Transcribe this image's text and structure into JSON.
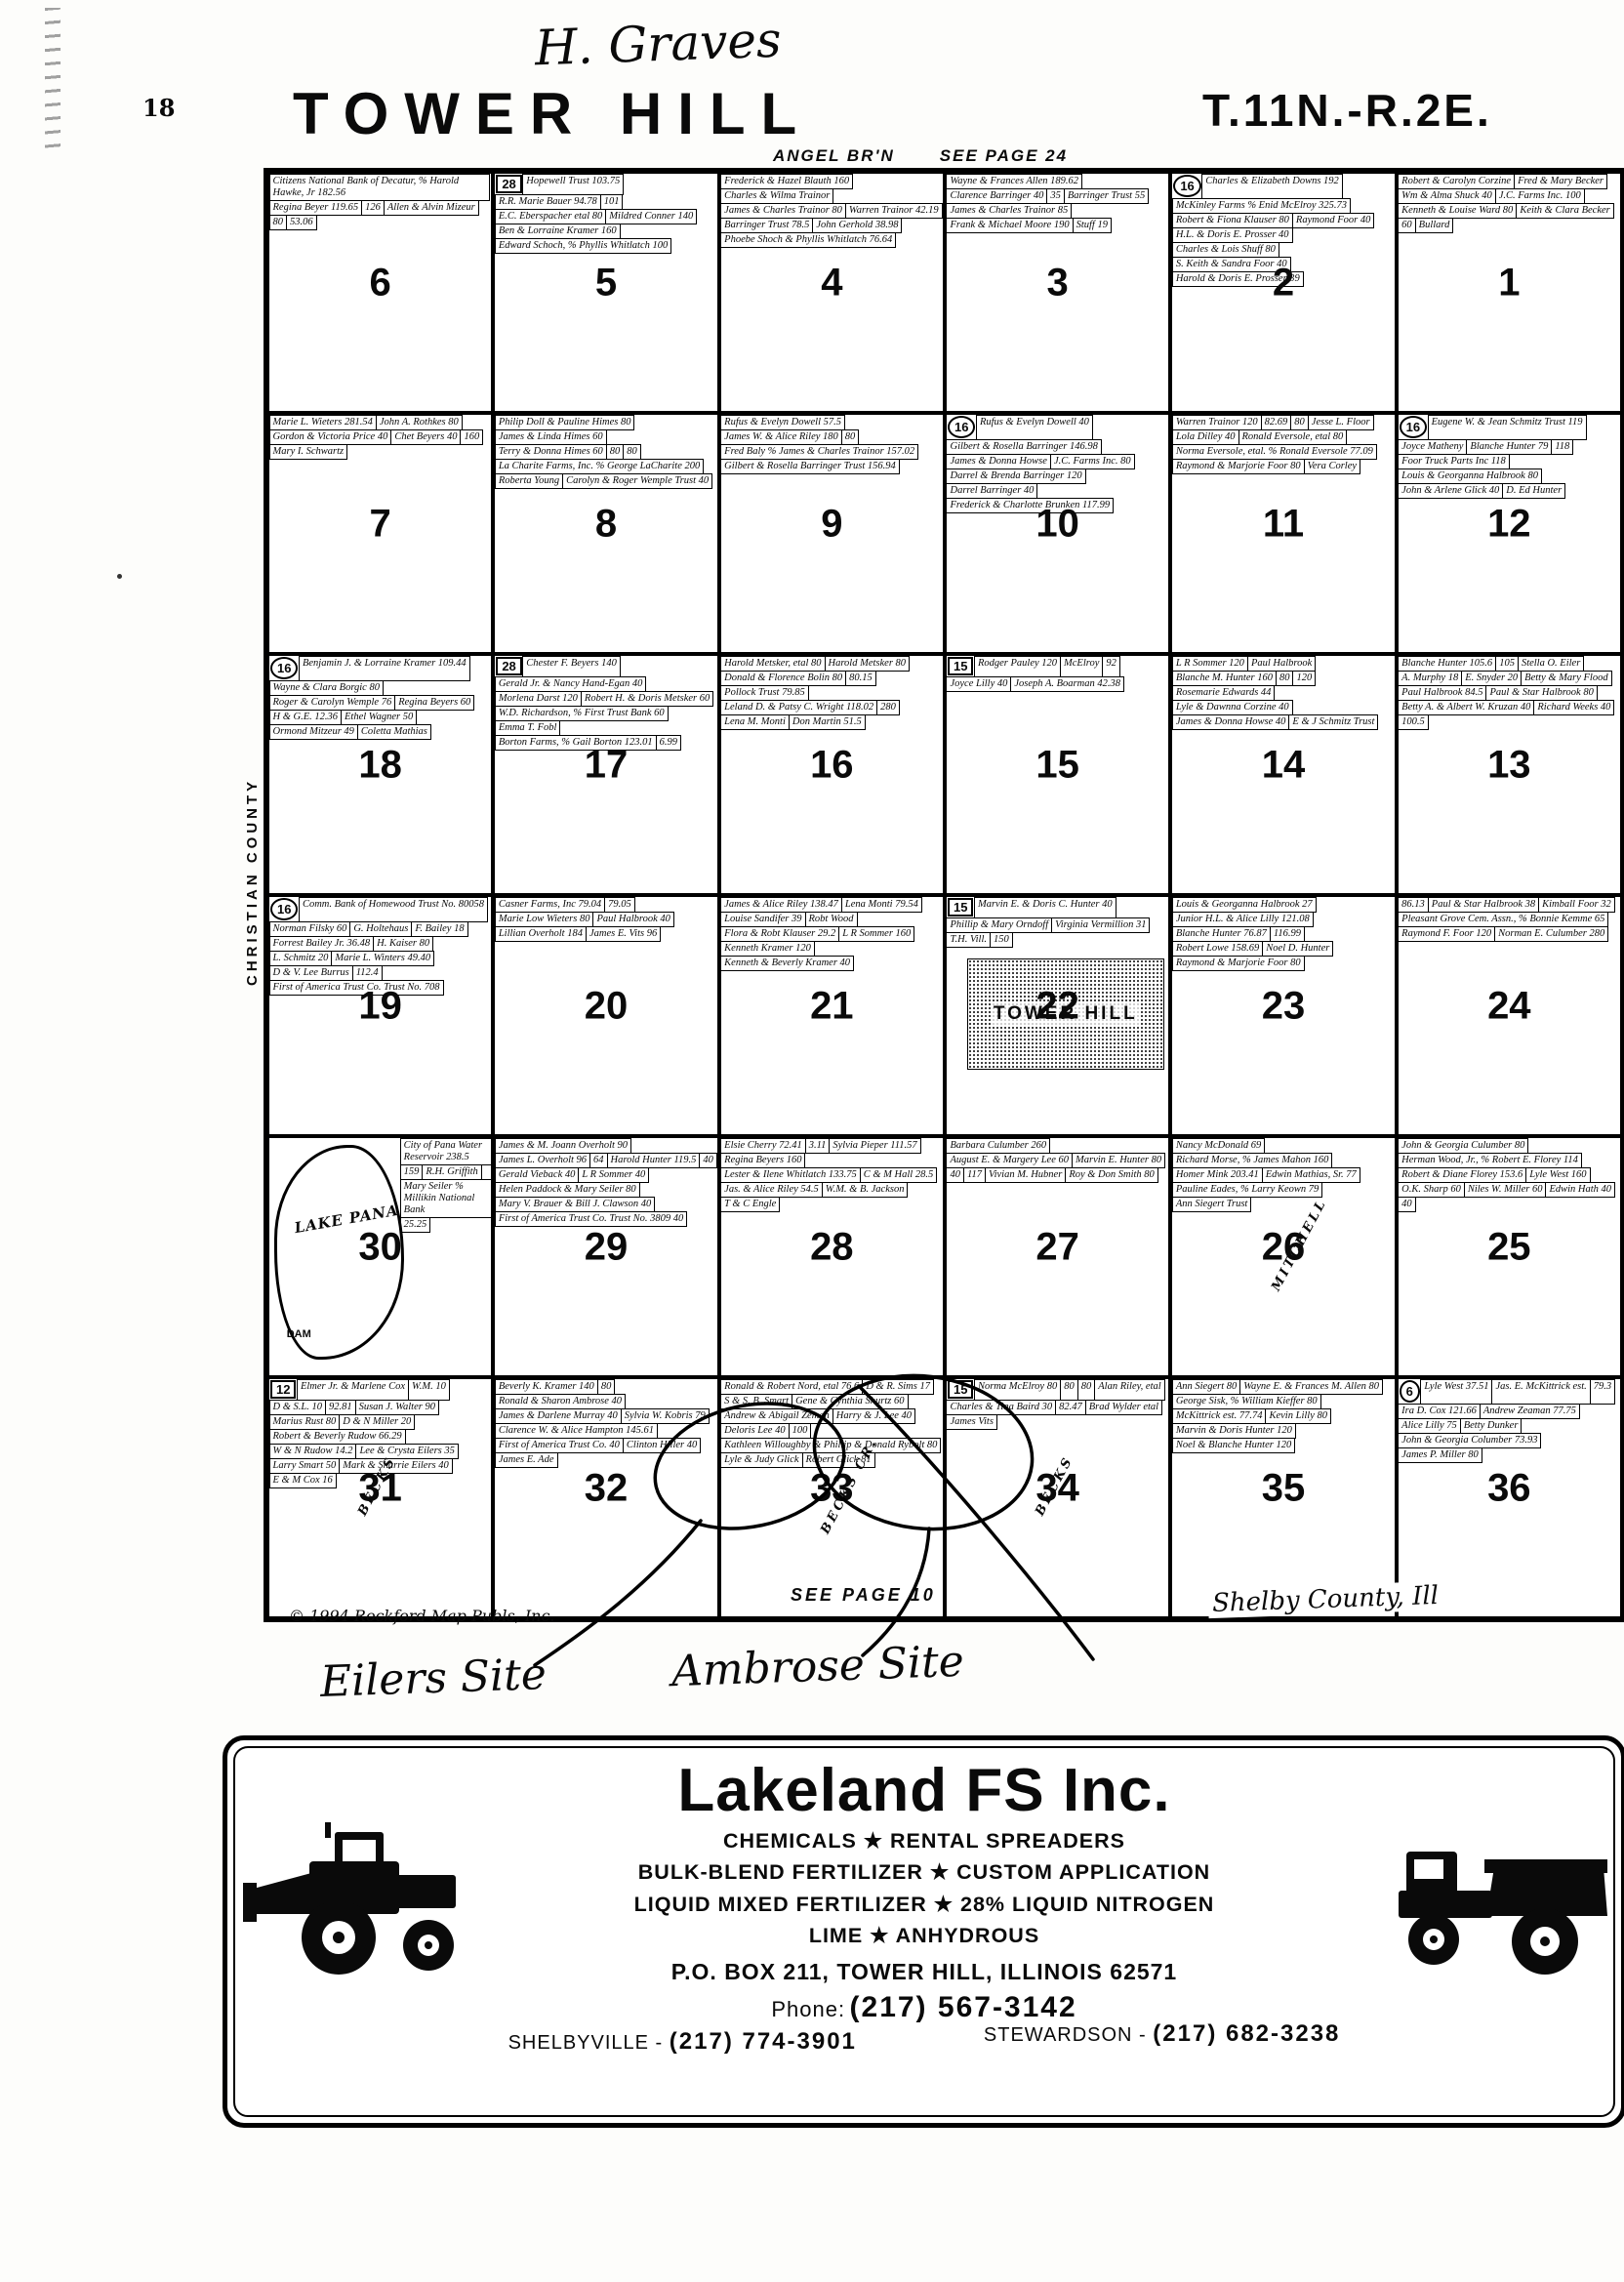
{
  "header": {
    "page_number": "18",
    "handwritten_name": "H. Graves",
    "title": "TOWER HILL",
    "township_range": "T.11N.-R.2E.",
    "stream_note": "ANGEL BR'N",
    "see_page_top": "SEE PAGE 24"
  },
  "footer": {
    "see_page_bottom": "SEE PAGE 10",
    "copyright": "© 1994 Rockford Map Publs, Inc.",
    "county_left": "CHRISTIAN COUNTY",
    "county_bottom": "Shelby County, Ill",
    "annotation_eilers": "Eilers Site",
    "annotation_ambrose": "Ambrose Site"
  },
  "map": {
    "sections": [
      {
        "n": "6",
        "parcels": [
          "Citizens National Bank of Decatur, % Harold Hawke, Jr 182.56",
          "Regina Beyer 119.65",
          "126",
          "Allen & Alvin Mizeur",
          "80",
          "53.06"
        ]
      },
      {
        "n": "5",
        "badges": [
          "28"
        ],
        "parcels": [
          "Hopewell Trust 103.75",
          "R.R. Marie Bauer 94.78",
          "101",
          "E.C. Eberspacher etal 80",
          "Mildred Conner 140",
          "Ben & Lorraine Kramer 160",
          "Edward Schoch, % Phyllis Whitlatch 100"
        ]
      },
      {
        "n": "4",
        "parcels": [
          "Frederick & Hazel Blauth 160",
          "Charles & Wilma Trainor",
          "James & Charles Trainor 80",
          "Warren Trainor 42.19",
          "Barringer Trust 78.5",
          "John Gerhold 38.98",
          "Phoebe Shoch & Phyllis Whitlatch 76.64"
        ]
      },
      {
        "n": "3",
        "parcels": [
          "Wayne & Frances Allen 189.62",
          "Clarence Barringer 40",
          "35",
          "Barringer Trust 55",
          "James & Charles Trainor 85",
          "Frank & Michael Moore 190",
          "Stuff 19"
        ]
      },
      {
        "n": "2",
        "badges": [
          "16"
        ],
        "parcels": [
          "Charles & Elizabeth Downs 192",
          "McKinley Farms % Enid McElroy 325.73",
          "Robert & Fiona Klauser 80",
          "Raymond Foor 40",
          "H.L. & Doris E. Prosser 40",
          "Charles & Lois Shuff 80",
          "S. Keith & Sandra Foor 40",
          "Harold & Doris E. Prosser 39"
        ]
      },
      {
        "n": "1",
        "parcels": [
          "Robert & Carolyn Corzine",
          "Fred & Mary Becker",
          "Wm & Alma Shuck 40",
          "J.C. Farms Inc. 100",
          "Kenneth & Louise Ward 80",
          "Keith & Clara Becker",
          "60",
          "Bullard"
        ]
      },
      {
        "n": "7",
        "parcels": [
          "Marie L. Wieters 281.54",
          "John A. Rothkes 80",
          "Gordon & Victoria Price 40",
          "Chet Beyers 40",
          "160",
          "Mary I. Schwartz"
        ]
      },
      {
        "n": "8",
        "parcels": [
          "Philip Doll & Pauline Himes 80",
          "James & Linda Himes 60",
          "Terry & Donna Himes 60",
          "80",
          "80",
          "La Charite Farms, Inc. % George LaCharite 200",
          "Roberta Young",
          "Carolyn & Roger Wemple Trust 40"
        ]
      },
      {
        "n": "9",
        "parcels": [
          "Rufus & Evelyn Dowell 57.5",
          "James W. & Alice Riley 180",
          "80",
          "Fred Baly % James & Charles Trainor 157.02",
          "Gilbert & Rosella Barringer Trust 156.94"
        ]
      },
      {
        "n": "10",
        "badges": [
          "16"
        ],
        "parcels": [
          "Rufus & Evelyn Dowell 40",
          "Gilbert & Rosella Barringer 146.98",
          "James & Donna Howse",
          "J.C. Farms Inc. 80",
          "Darrel & Brenda Barringer 120",
          "Darrel Barringer 40",
          "Frederick & Charlotte Brunken 117.99"
        ]
      },
      {
        "n": "11",
        "parcels": [
          "Warren Trainor 120",
          "82.69",
          "80",
          "Jesse L. Floor",
          "Lola Dilley 40",
          "Ronald Eversole, etal 80",
          "Norma Eversole, etal. % Ronald Eversole 77.09",
          "Raymond & Marjorie Foor 80",
          "Vera Corley"
        ]
      },
      {
        "n": "12",
        "badges": [
          "16"
        ],
        "parcels": [
          "Eugene W. & Jean Schmitz Trust 119",
          "Joyce Matheny",
          "Blanche Hunter 79",
          "118",
          "Foor Truck Parts Inc 118",
          "Louis & Georganna Halbrook 80",
          "John & Arlene Glick 40",
          "D. Ed Hunter"
        ]
      },
      {
        "n": "18",
        "badges": [
          "16"
        ],
        "parcels": [
          "Benjamin J. & Lorraine Kramer 109.44",
          "Wayne & Clara Borgic 80",
          "Roger & Carolyn Wemple 76",
          "Regina Beyers 60",
          "H & G.E. 12.36",
          "Ethel Wagner 50",
          "Ormond Mitzeur 49",
          "Coletta Mathias"
        ]
      },
      {
        "n": "17",
        "badges": [
          "28"
        ],
        "parcels": [
          "Chester F. Beyers 140",
          "Gerald Jr. & Nancy Hand-Egan 40",
          "Morlena Darst 120",
          "Robert H. & Doris Metsker 60",
          "W.D. Richardson, % First Trust Bank 60",
          "Emma T. Fobl",
          "Borton Farms, % Gail Borton 123.01",
          "6.99"
        ]
      },
      {
        "n": "16",
        "parcels": [
          "Harold Metsker, etal 80",
          "Harold Metsker 80",
          "Donald & Florence Bolin 80",
          "80.15",
          "Pollock Trust 79.85",
          "Leland D. & Patsy C. Wright 118.02",
          "280",
          "Lena M. Monti",
          "Don Martin 51.5"
        ]
      },
      {
        "n": "15",
        "badges": [
          "15"
        ],
        "parcels": [
          "Rodger Pauley 120",
          "McElroy",
          "92",
          "Joyce Lilly 40",
          "Joseph A. Boarman 42.38"
        ]
      },
      {
        "n": "14",
        "parcels": [
          "L R Sommer 120",
          "Paul Halbrook",
          "Blanche M. Hunter 160",
          "80",
          "120",
          "Rosemarie Edwards 44",
          "Lyle & Dawnna Corzine 40",
          "James & Donna Howse 40",
          "E & J Schmitz Trust"
        ]
      },
      {
        "n": "13",
        "parcels": [
          "Blanche Hunter 105.6",
          "105",
          "Stella O. Eiler",
          "A. Murphy 18",
          "E. Snyder 20",
          "Betty & Mary Flood",
          "Paul Halbrook 84.5",
          "Paul & Star Halbrook 80",
          "Betty A. & Albert W. Kruzan 40",
          "Richard Weeks 40",
          "100.5"
        ]
      },
      {
        "n": "19",
        "badges": [
          "16"
        ],
        "parcels": [
          "Comm. Bank of Homewood Trust No. 80058",
          "Norman Filsky 60",
          "G. Holtehaus",
          "F. Bailey 18",
          "Forrest Bailey Jr. 36.48",
          "H. Kaiser 80",
          "L. Schmitz 20",
          "Marie L. Winters 49.40",
          "D & V. Lee Burrus",
          "112.4",
          "First of America Trust Co. Trust No. 708"
        ]
      },
      {
        "n": "20",
        "parcels": [
          "Casner Farms, Inc 79.04",
          "79.05",
          "Marie Low Wieters 80",
          "Paul Halbrook 40",
          "Lillian Overholt 184",
          "James E. Vits 96"
        ]
      },
      {
        "n": "21",
        "parcels": [
          "James & Alice Riley 138.47",
          "Lena Monti 79.54",
          "Louise Sandifer 39",
          "Robt Wood",
          "Flora & Robt Klauser 29.2",
          "L R Sommer 160",
          "Kenneth Kramer 120",
          "Kenneth & Beverly Kramer 40"
        ]
      },
      {
        "n": "22",
        "badges": [
          "15"
        ],
        "town": "TOWER HILL",
        "parcels": [
          "Marvin E. & Doris C. Hunter 40",
          "Phillip & Mary Orndoff",
          "Virginia Vermillion 31",
          "T.H. Vill.",
          "150"
        ]
      },
      {
        "n": "23",
        "parcels": [
          "Louis & Georganna Halbrook 27",
          "Junior H.L. & Alice Lilly 121.08",
          "Blanche Hunter 76.87",
          "116.99",
          "Robert Lowe 158.69",
          "Noel D. Hunter",
          "Raymond & Marjorie Foor 80"
        ]
      },
      {
        "n": "24",
        "parcels": [
          "86.13",
          "Paul & Star Halbrook 38",
          "Kimball Foor 32",
          "Pleasant Grove Cem. Assn., % Bonnie Kemme 65",
          "Raymond F. Foor 120",
          "Norman E. Culumber 280"
        ]
      },
      {
        "n": "30",
        "lake": {
          "name": "LAKE PANA",
          "dam": "DAM"
        },
        "parcels": [
          "City of Pana Water Reservoir 238.5",
          "159",
          "R.H. Griffith",
          "Mary Seiler % Millikin National Bank",
          "25.25"
        ]
      },
      {
        "n": "29",
        "parcels": [
          "James & M. Joann Overholt 90",
          "James L. Overholt 96",
          "64",
          "Harold Hunter 119.5",
          "40",
          "Gerald Vieback 40",
          "L R Sommer 40",
          "Helen Paddock & Mary Seiler 80",
          "Mary V. Brauer & Bill J. Clawson 40",
          "First of America Trust Co. Trust No. 3809 40"
        ]
      },
      {
        "n": "28",
        "parcels": [
          "Elsie Cherry 72.41",
          "3.11",
          "Sylvia Pieper 111.57",
          "Regina Beyers 160",
          "Lester & Ilene Whitlatch 133.75",
          "C & M Hall 28.5",
          "Jas. & Alice Riley 54.5",
          "W.M. & B. Jackson",
          "T & C Engle"
        ]
      },
      {
        "n": "27",
        "parcels": [
          "Barbara Culumber 260",
          "August E. & Margery Lee 60",
          "Marvin E. Hunter 80",
          "40",
          "117",
          "Vivian M. Hubner",
          "Roy & Don Smith 80"
        ]
      },
      {
        "n": "26",
        "creek": "MITCHELL",
        "parcels": [
          "Nancy McDonald 69",
          "Richard Morse, % James Mahon 160",
          "Homer Mink 203.41",
          "Edwin Mathias, Sr. 77",
          "Pauline Eades, % Larry Keown 79",
          "Ann Siegert Trust"
        ]
      },
      {
        "n": "25",
        "parcels": [
          "John & Georgia Culumber 80",
          "Herman Wood, Jr., % Robert E. Florey 114",
          "Robert & Diane Florey 153.6",
          "Lyle West 160",
          "O.K. Sharp 60",
          "Niles W. Miller 60",
          "Edwin Hath 40",
          "40"
        ]
      },
      {
        "n": "31",
        "badges": [
          "12"
        ],
        "creek": "BECKS",
        "parcels": [
          "Elmer Jr. & Marlene Cox",
          "W.M. 10",
          "D & S.L. 10",
          "92.81",
          "Susan J. Walter 90",
          "Marius Rust 80",
          "D & N Miller 20",
          "Robert & Beverly Rudow 66.29",
          "W & N Rudow 14.2",
          "Lee & Crysta Eilers 35",
          "Larry Smart 50",
          "Mark & Sharrie Eilers 40",
          "E & M Cox 16"
        ]
      },
      {
        "n": "32",
        "parcels": [
          "Beverly K. Kramer 140",
          "80",
          "Ronald & Sharon Ambrose 40",
          "James & Darlene Murray 40",
          "Sylvia W. Kobris 79",
          "Clarence W. & Alice Hampton 145.61",
          "First of America Trust Co. 40",
          "Clinton Hiller 40",
          "James E. Ade"
        ]
      },
      {
        "n": "33",
        "creek": "BECKS CR.",
        "parcels": [
          "Ronald & Robert Nord, etal 76.6",
          "D & R. Sims 17",
          "S & S. B. Smart",
          "Gene & Cynthia Shurtz 60",
          "Andrew & Abigail Zeman",
          "Harry & J. Lee 40",
          "Deloris Lee 40",
          "100",
          "Kathleen Willoughby & Phillip & Donald Rybolt 80",
          "Lyle & Judy Glick",
          "Robert Glick 81"
        ]
      },
      {
        "n": "34",
        "badges": [
          "15"
        ],
        "creek": "BECKS",
        "parcels": [
          "Norma McElroy 80",
          "80",
          "80",
          "Alan Riley, etal",
          "Charles & Tina Baird 30",
          "82.47",
          "Brad Wylder etal",
          "James Vits"
        ]
      },
      {
        "n": "35",
        "parcels": [
          "Ann Siegert 80",
          "Wayne E. & Frances M. Allen 80",
          "George Sisk, % William Kieffer 80",
          "McKittrick est. 77.74",
          "Kevin Lilly 80",
          "Marvin & Doris Hunter 120",
          "Noel & Blanche Hunter 120"
        ]
      },
      {
        "n": "36",
        "badges": [
          "6"
        ],
        "parcels": [
          "Lyle West 37.51",
          "Jas. E. McKittrick est.",
          "79.3",
          "Ira D. Cox 121.66",
          "Andrew Zeaman 77.75",
          "Alice Lilly 75",
          "Betty Dunker",
          "John & Georgia Columber 73.93",
          "James P. Miller 80"
        ]
      }
    ]
  },
  "ad": {
    "company": "Lakeland FS Inc.",
    "services": [
      "CHEMICALS ★ RENTAL SPREADERS",
      "BULK-BLEND FERTILIZER ★ CUSTOM APPLICATION",
      "LIQUID MIXED FERTILIZER ★ 28% LIQUID NITROGEN",
      "LIME ★ ANHYDROUS"
    ],
    "address": "P.O. BOX 211, TOWER HILL, ILLINOIS 62571",
    "phone_label": "Phone:",
    "phone": "(217) 567-3142",
    "branch_left_name": "SHELBYVILLE - ",
    "branch_left_phone": "(217) 774-3901",
    "branch_right_name": "STEWARDSON - ",
    "branch_right_phone": "(217) 682-3238"
  }
}
